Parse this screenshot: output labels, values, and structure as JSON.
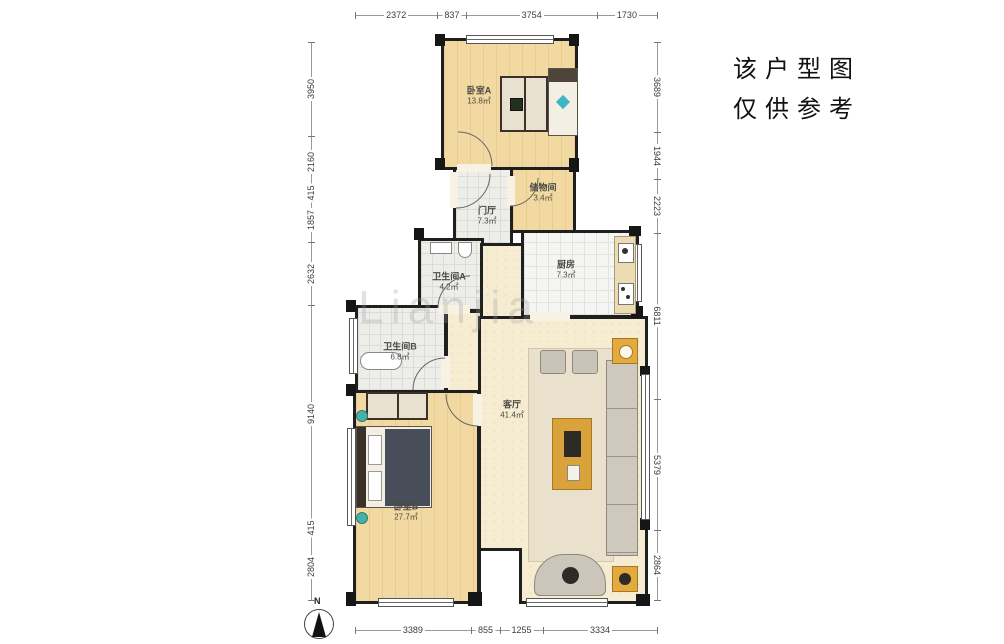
{
  "note": {
    "line1": "该户型图",
    "line2": "仅供参考"
  },
  "compass": {
    "label": "N"
  },
  "watermark": "Lianjia",
  "rooms": [
    {
      "id": "bedroom-a",
      "name": "卧室A",
      "area": "13.8㎡"
    },
    {
      "id": "storage",
      "name": "储物间",
      "area": "3.4㎡"
    },
    {
      "id": "hall",
      "name": "门厅",
      "area": "7.3㎡"
    },
    {
      "id": "kitchen",
      "name": "厨房",
      "area": "7.3㎡"
    },
    {
      "id": "bath-a",
      "name": "卫生间A",
      "area": "4.2㎡"
    },
    {
      "id": "bath-b",
      "name": "卫生间B",
      "area": "6.8㎡"
    },
    {
      "id": "living",
      "name": "客厅",
      "area": "41.4㎡"
    },
    {
      "id": "bedroom-b",
      "name": "卧室B",
      "area": "27.7㎡"
    }
  ],
  "dimensions": {
    "top": [
      2372,
      837,
      3754,
      1730
    ],
    "bottom": [
      3389,
      855,
      1255,
      3334
    ],
    "left": [
      3950,
      2160,
      415,
      1857,
      2632,
      9140,
      415,
      2804
    ],
    "right": [
      3689,
      1944,
      2223,
      6811,
      5379,
      2864
    ]
  },
  "colors": {
    "wall": "#1f1f1f",
    "wood_floor": "#f2d9a2",
    "living_floor": "#f6ecd2",
    "accent_gold": "#d9a23b",
    "accent_teal": "#44b2b8"
  }
}
